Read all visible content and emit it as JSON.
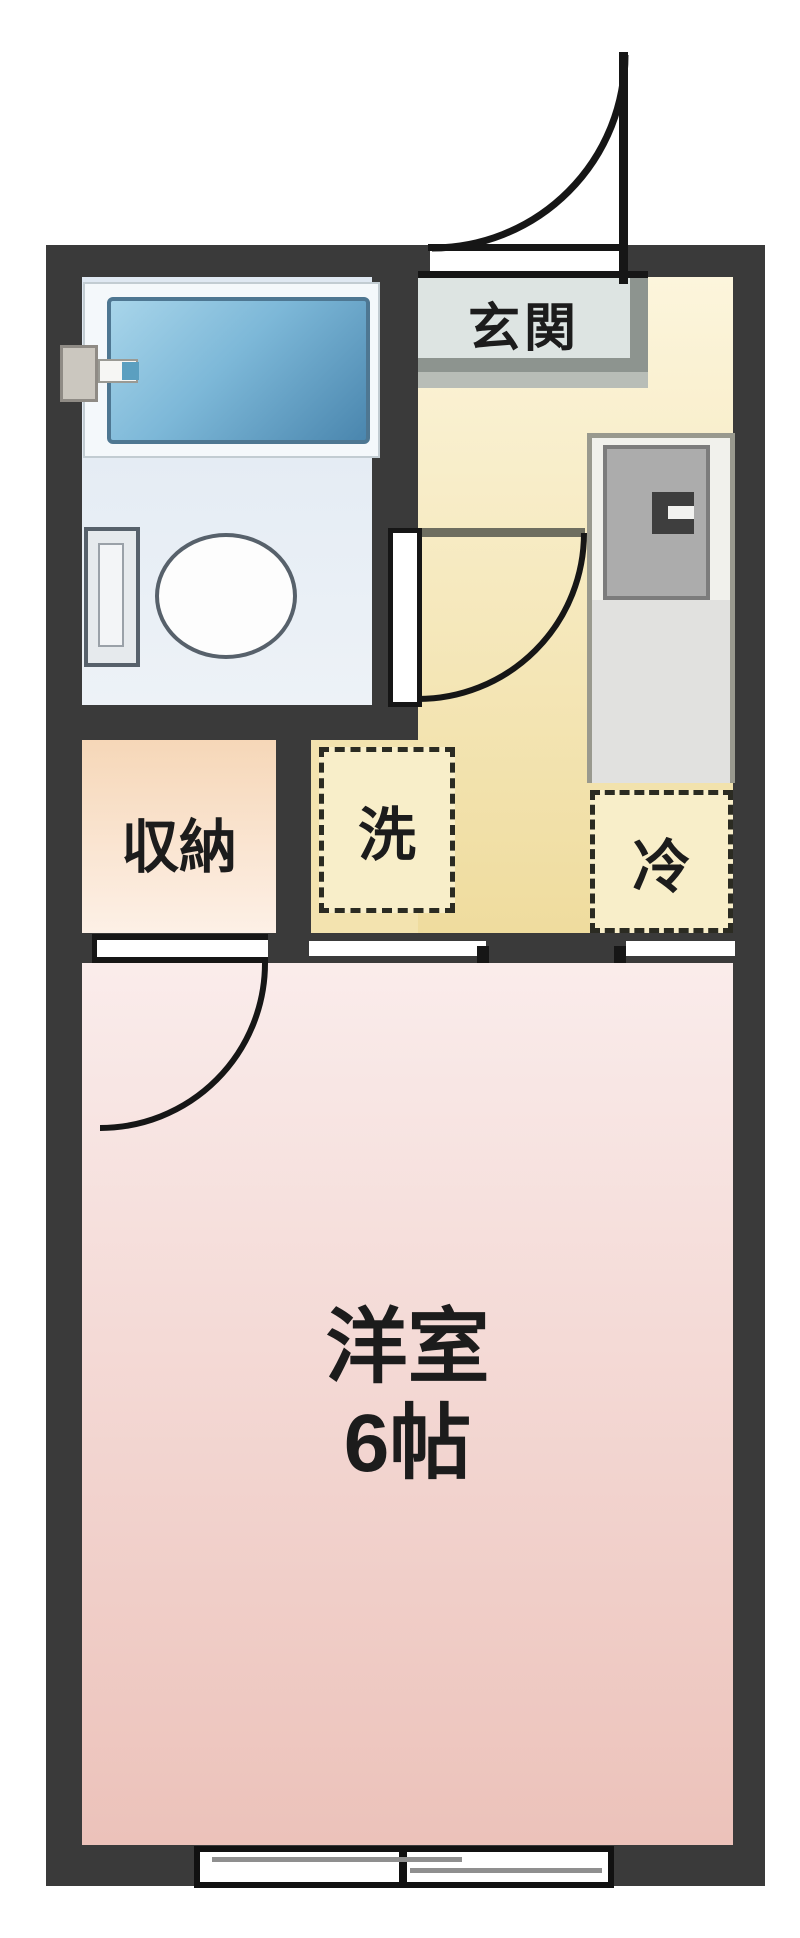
{
  "labels": {
    "entrance": "玄関",
    "closet": "収納",
    "washer": "洗",
    "fridge": "冷",
    "room_line1": "洋室",
    "room_line2": "6帖"
  },
  "palette": {
    "wall": "#3a3a3a",
    "line": "#161616",
    "hall-top": "#fcf5dc",
    "hall-bottom": "#efdc9e",
    "hall-west": "#f3e3af",
    "closet-top": "#f6d7b8",
    "closet-bottom": "#fdf0e6",
    "room-top": "#faeceb",
    "room-bottom": "#ecc2ba",
    "bath-top": "#dfe8f2",
    "bath-bottom": "#edf2f7",
    "tub-light": "#a8d5ea",
    "tub-dark": "#4a86ae",
    "tub-border": "#4e7792",
    "genkan-fill": "#dde4e2",
    "genkan-border": "#8d948f",
    "genkan-step": "#b8bdb7",
    "kitchen-fill": "#f1f1ec",
    "kitchen-border": "#99998e",
    "kitchen-panel": "#acacac",
    "kitchen-panel-border": "#7c7c7c",
    "kitchen-lower": "#e1e1df",
    "dash-fill": "#f8eec9",
    "dash-border": "#2b2b22",
    "toilet-border": "#57616b",
    "frame-line": "#6e6e60",
    "glass-line": "#8f8f8f"
  }
}
